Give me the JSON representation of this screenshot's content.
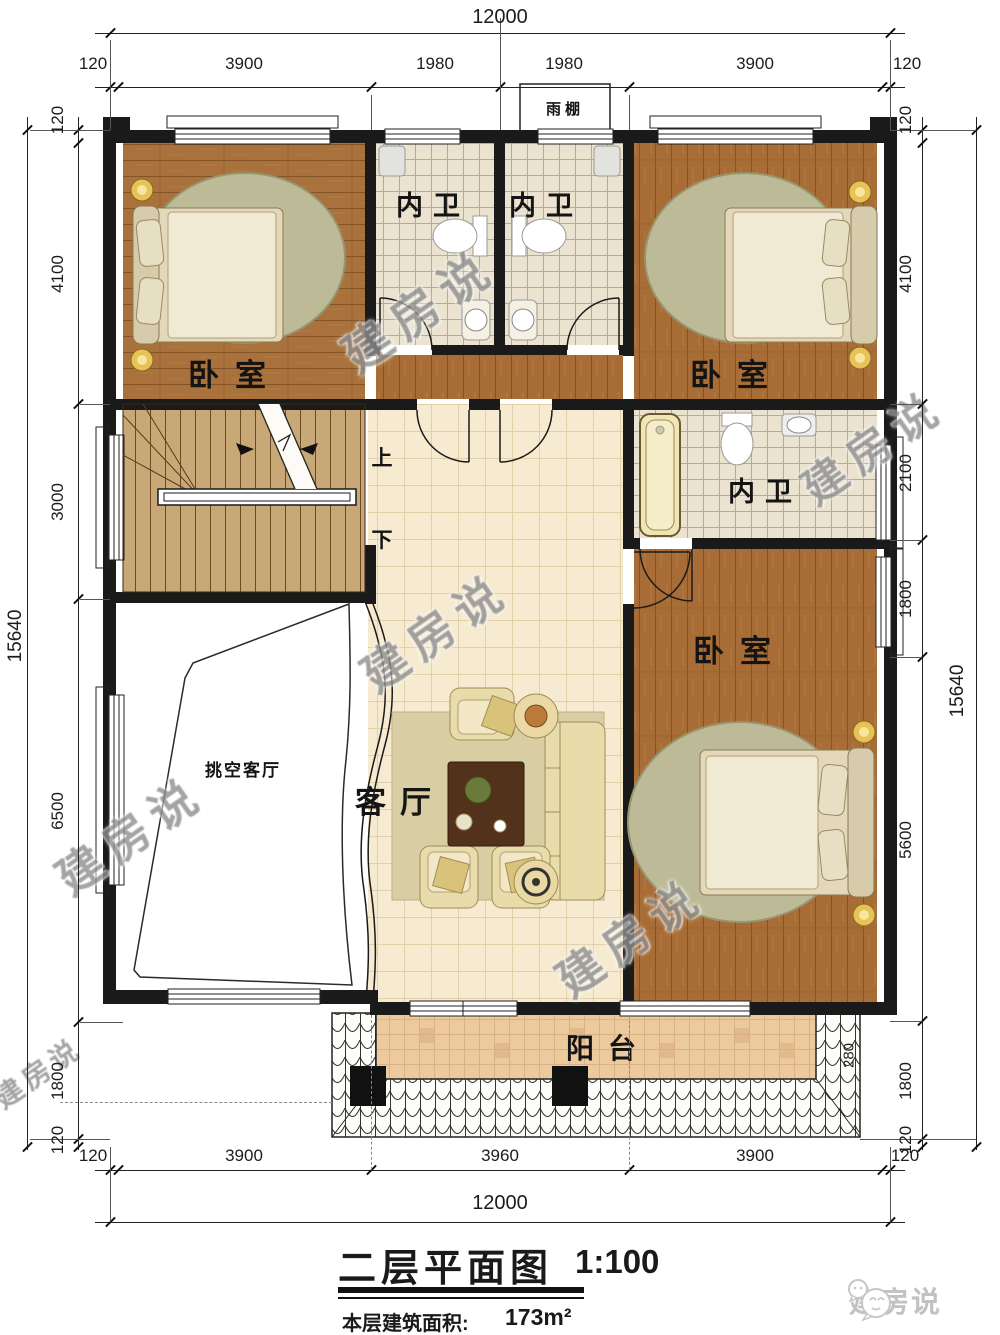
{
  "watermark": {
    "text": "建房说"
  },
  "logo": {
    "brand": "建房说"
  },
  "title": {
    "name": "二层平面图",
    "scale": "1:100",
    "area_label": "本层建筑面积:",
    "area_value": "173m²"
  },
  "rooms": {
    "bedroom_top_left": "卧室",
    "bedroom_top_right": "卧室",
    "bedroom_right": "卧室",
    "bath_top_left": "内卫",
    "bath_top_right": "内卫",
    "bath_middle": "内卫",
    "living": "客厅",
    "void_living": "挑空客厅",
    "balcony": "阳台",
    "canopy": "雨棚"
  },
  "stairs": {
    "up": "上",
    "down": "下"
  },
  "dimensions": {
    "top": {
      "total": "12000",
      "segments": [
        "120",
        "3900",
        "1980",
        "1980",
        "3900",
        "120"
      ]
    },
    "bottom": {
      "total": "12000",
      "segments": [
        "120",
        "3900",
        "3960",
        "3900",
        "120"
      ]
    },
    "left": {
      "total": "15640",
      "segments": [
        "120",
        "4100",
        "3000",
        "6500",
        "1800",
        "120"
      ]
    },
    "right": {
      "total": "15640",
      "segments": [
        "120",
        "4100",
        "2100",
        "1800",
        "5600",
        "1800",
        "120"
      ]
    },
    "balcony_offset": "280"
  },
  "colors": {
    "wall": "#1a1a1a",
    "wood": "#a9713b",
    "bath_tile": "#ebe2d0",
    "living_tile": "#f6ead0",
    "balcony_tile": "#ecca9e",
    "stair": "#c9a877",
    "watermark_gray": "#8e8e8e"
  }
}
